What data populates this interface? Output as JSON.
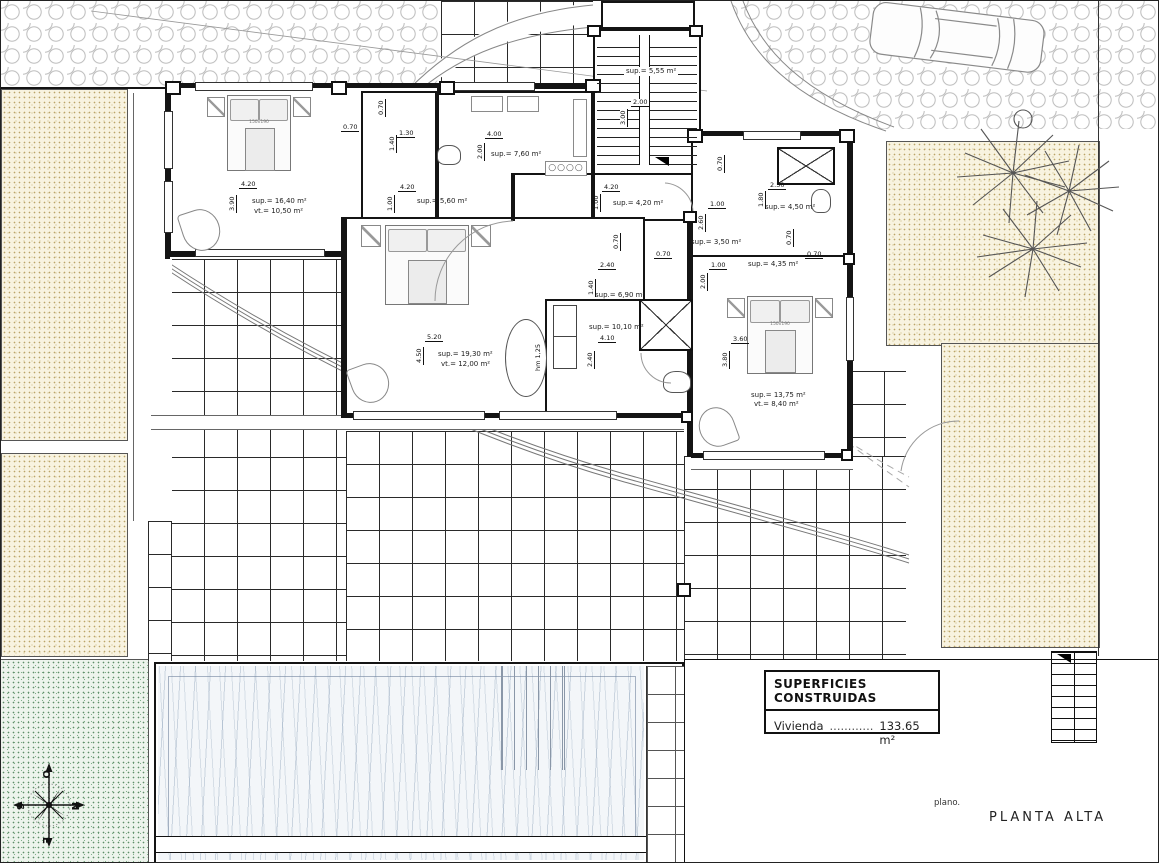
{
  "meta": {
    "plan_label": "plano.",
    "plan_title": "PLANTA ALTA"
  },
  "title_block": {
    "header": "SUPERFICIES CONSTRUIDAS",
    "row_label": "Vivienda",
    "dots": "............",
    "value": "133.65 m²"
  },
  "compass": {
    "o": "O",
    "n": "N",
    "e": "E",
    "s": "S"
  },
  "rooms": [
    {
      "key": "dormitorio-1",
      "sup": "sup.= 16,40 m²",
      "vt": "vt.= 10,50 m²",
      "w": "4.20",
      "h": "3.90"
    },
    {
      "key": "pasillo",
      "sup": "sup.= 5,60 m²",
      "w": "4.20",
      "h": "1.00"
    },
    {
      "key": "cocina-lavadero",
      "sup": "sup.= 7,60 m²",
      "w": "4.00",
      "h": "2.00"
    },
    {
      "key": "escalera",
      "sup": "sup.= 5,55 m²",
      "w": "2.00",
      "h": "3.00"
    },
    {
      "key": "hall",
      "sup": "sup.= 4,20 m²",
      "w": "4.20",
      "h": "1.00"
    },
    {
      "key": "distribuidor",
      "sup": "sup.= 6,90 m²",
      "w": "2.40",
      "h": "1.40"
    },
    {
      "key": "bano",
      "sup": "sup.= 10,10 m²",
      "w": "4.10",
      "h": "2.40"
    },
    {
      "key": "aseo",
      "sup": "sup.= 4,50 m²",
      "w": "2.50",
      "h": "1.80"
    },
    {
      "key": "vestidor-1",
      "sup": "sup.= 3,50 m²",
      "w": "1.00",
      "h": "2.60"
    },
    {
      "key": "vestidor-2",
      "sup": "sup.= 4,35 m²",
      "w": "1.00",
      "h": "2.00"
    },
    {
      "key": "dormitorio-principal",
      "sup": "sup.= 19,30 m²",
      "vt": "vt.= 12,00 m²",
      "w": "5.20",
      "h": "4.50"
    },
    {
      "key": "dormitorio-2",
      "sup": "sup.= 13,75 m²",
      "vt": "vt.= 8,40 m²",
      "w": "3.60",
      "h": "3.80"
    }
  ],
  "extra": {
    "d070": "0.70",
    "nook_w": "1.30",
    "nook_h": "1.40",
    "hm": "hm 1,25",
    "bed_size": "150x190"
  }
}
